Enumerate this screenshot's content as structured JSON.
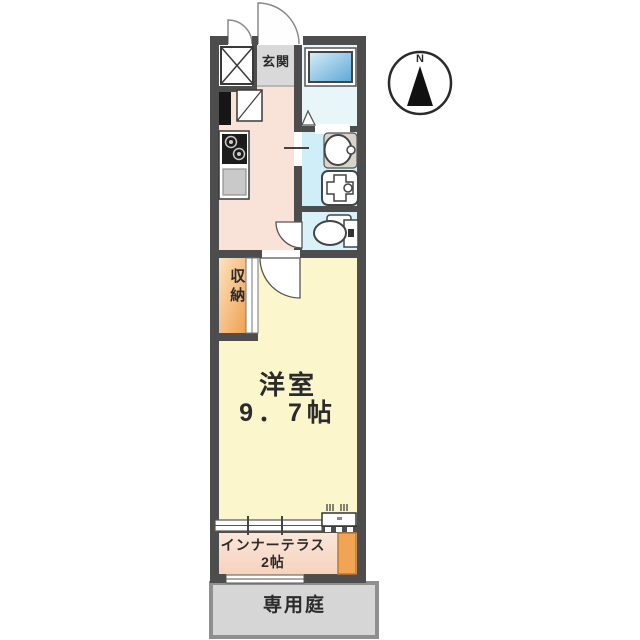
{
  "compass": {
    "north_label": "N"
  },
  "rooms": {
    "genkan": {
      "label": "玄関"
    },
    "closet": {
      "label": "収納"
    },
    "main_room": {
      "label": "洋室",
      "size": "9．7帖"
    },
    "inner_terrace": {
      "label": "インナーテラス",
      "size": "2帖"
    },
    "private_garden": {
      "label": "専用庭"
    }
  },
  "colors": {
    "wall": "#4d4d4d",
    "hallway_floor": "#f9e2d7",
    "genkan_tile": "#d9d9d9",
    "bath_floor": "#e8f6fa",
    "washroom_floor": "#cfeef8",
    "toilet_floor": "#d9f1f8",
    "bathtub_light": "#d6edf8",
    "bathtub_dark": "#5ea7d6",
    "room_floor": "#fbf6cb",
    "closet_light": "#fce3bf",
    "closet_dark": "#f0a050",
    "terrace_floor": "#f9dcca",
    "terrace_block": "#f2a455",
    "garden_fill": "#d6d6d6",
    "garden_border": "#8f8f8f",
    "sink": "#c9c9c9"
  }
}
